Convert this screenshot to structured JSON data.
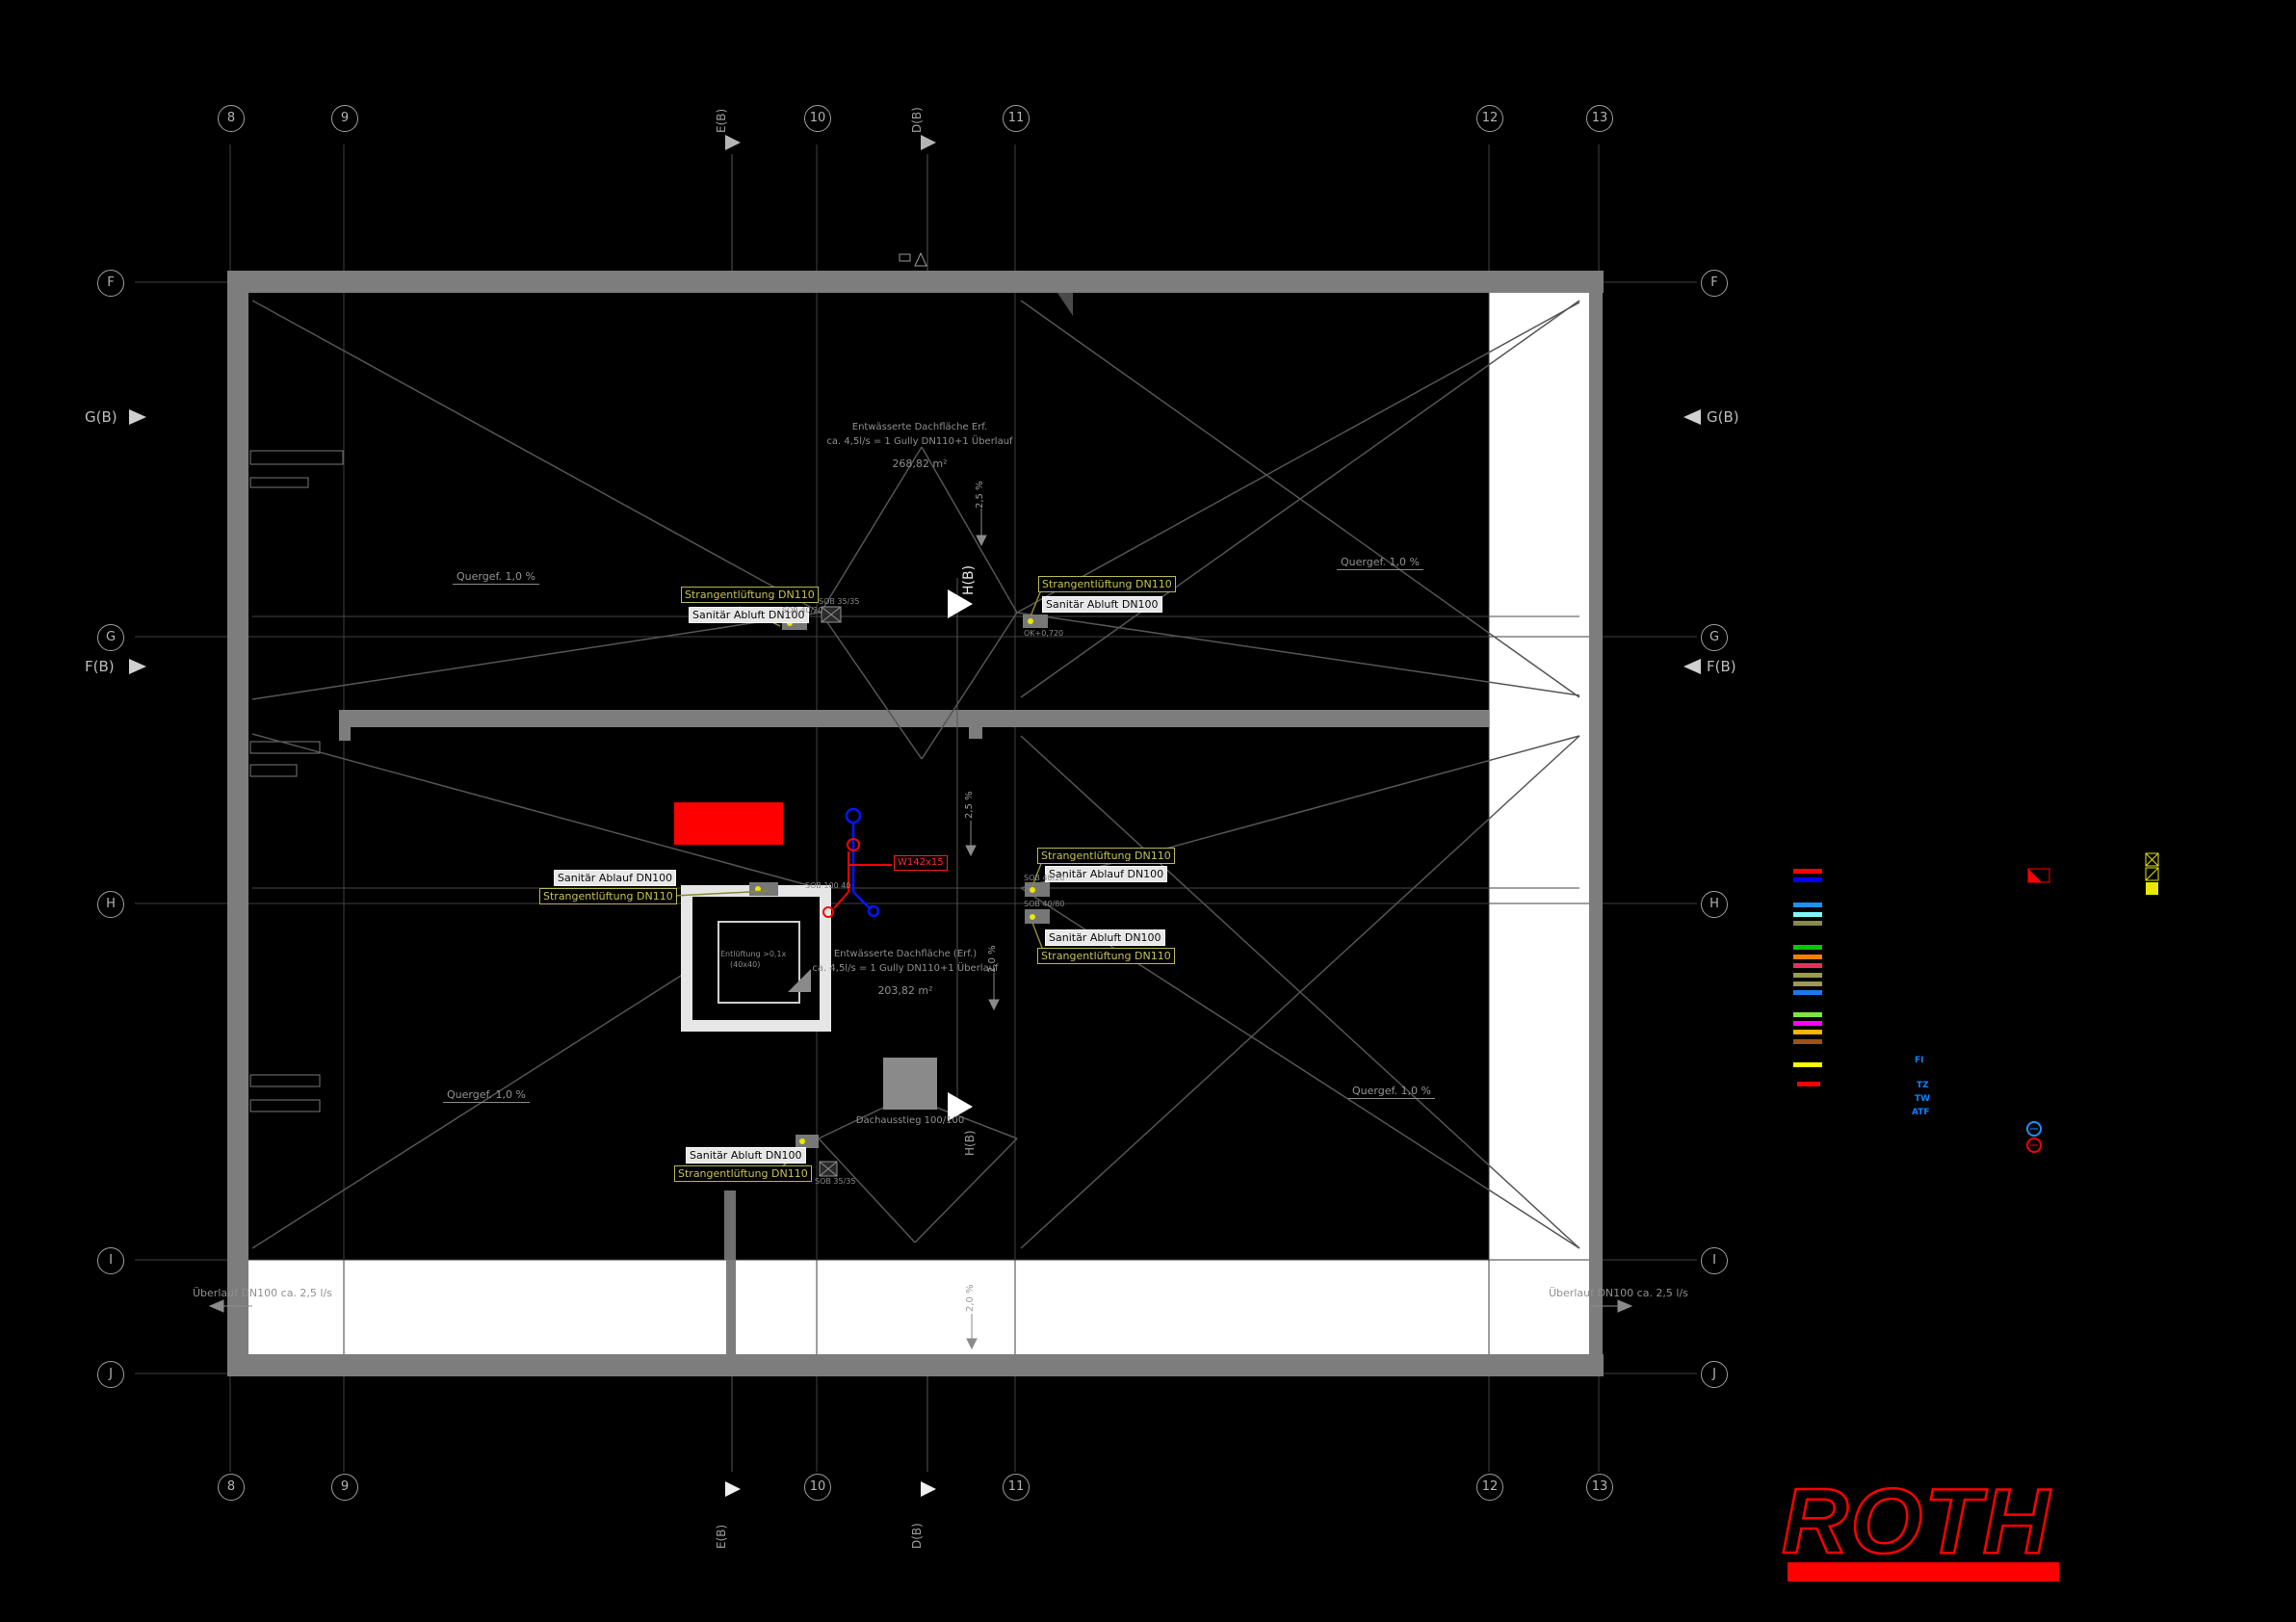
{
  "grid": {
    "cols": [
      "8",
      "9",
      "10",
      "11",
      "12",
      "13"
    ],
    "rows": [
      "F",
      "G",
      "H",
      "I",
      "J"
    ],
    "markers": {
      "gb": "G(B)",
      "fb": "F(B)",
      "eb": "E(B)",
      "db": "D(B)",
      "hb": "H(B)"
    }
  },
  "labels": {
    "strang": "Strangentlüftung DN110",
    "abluft": "Sanitär Abluft DN100",
    "ablauf": "Sanitär Ablauf DN100",
    "quergef": "Quergef. 1,0 %",
    "ueberlauf": "Überlauf DN100 ca. 2,5 l/s",
    "dachausstieg": "Dachausstieg 100/100",
    "entlueftung1": "Entlüftung >0,1x",
    "entlueftung2": "(40x40)",
    "red_tag": "W142x15",
    "slope25": "2,5 %",
    "slope20": "2,0 %",
    "code_sob3535": "SOB 35/35",
    "code_sob4020": "SOB 40/20",
    "code_sob4080": "SOB 40/80",
    "code_sob10040": "SOB 100 40",
    "code_ok": "OK+0,720"
  },
  "annotations": {
    "top": {
      "l1": "Entwässerte Dachfläche Erf.",
      "l2": "ca. 4,5l/s = 1 Gully DN110+1 Überlauf",
      "l3": "268,82 m²"
    },
    "mid": {
      "l1": "Entwässerte Dachfläche (Erf.)",
      "l2": "ca. 4,5l/s = 1 Gully DN110+1 Überlauf",
      "l3": "203,82 m²"
    }
  },
  "legend": {
    "colors": [
      "#ff0000",
      "#0000ff",
      "#1e90ff",
      "#7ff7f7",
      "#8a8a4a",
      "#00c800",
      "#ff7f00",
      "#e6305a",
      "#9a9a50",
      "#9a9a50",
      "#1e78e6",
      "#7fe63c",
      "#ff00ff",
      "#ffb400",
      "#a05014",
      "#ffff00",
      "#ff0000"
    ],
    "labels": [
      "FI",
      "TZ",
      "TW",
      "ATF"
    ]
  },
  "logo": {
    "text": "ROTH"
  }
}
